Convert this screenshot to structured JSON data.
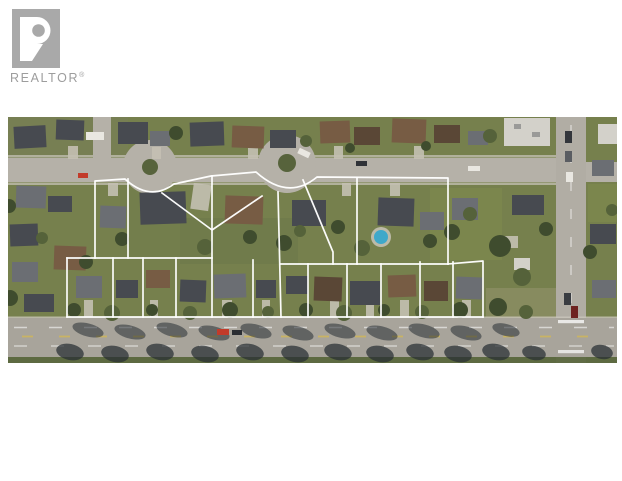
{
  "branding": {
    "logo_text": "REALTOR",
    "registered_symbol": "®"
  },
  "photo": {
    "description": "Aerial drone photo of a suburban neighbourhood: residential street with two cul-de-sac bulbs at top, rows of homes and mature trees, two tiers of property lots outlined in white, a tree-lined arterial road across the bottom and a cross street with an intersection at the right.",
    "palette": {
      "grass": "#76804d",
      "grass-dark": "#5c6840",
      "lawn": "#7f8a4f",
      "road": "#b5b1a8",
      "road-main": "#a8a49b",
      "road-cross": "#b1ada4",
      "sidewalk": "#cac6bc",
      "roof-dark": "#474a50",
      "roof-gray": "#6b6e73",
      "roof-brown": "#775c44",
      "roof-brown-dark": "#5a4736",
      "roof-light": "#d3d1ca",
      "tree": "#3f4c2e",
      "tree-light": "#55623a",
      "shadow": "#272e33",
      "pool": "#3fa8c9",
      "car-red": "#c23b2a",
      "lane-yellow": "#d4b952",
      "drive": "#c4c0b3",
      "island": "#57633c",
      "logo-gray": "#a9a9a9",
      "logo-text": "#9d9d9d"
    },
    "lot_overlay": {
      "stroke_color": "#ffffff",
      "stroke_width": 1.7,
      "upper_lot_count": 6,
      "lower_lot_count": 12,
      "paths": [
        "M95,258 L95,181 L125,179 Q150,202 174,184 L211,176 L256,172 Q288,201 317,177 L448,178 L448,264",
        "M281,264 L448,264",
        "M128,179 L128,258",
        "M162,193 L212,230 L262,196",
        "M212,176 L212,317",
        "M253,260 L253,317",
        "M278,192 L281,317",
        "M303,180 L333,252 L333,264",
        "M357,178 L357,264",
        "M67,258 L212,258",
        "M67,258 L67,317",
        "M67,317 L483,317",
        "M483,317 L483,261 L448,264",
        "M113,258 L113,317",
        "M143,258 L143,317",
        "M176,258 L176,317",
        "M308,264 L308,317",
        "M347,264 L347,317",
        "M381,264 L381,317",
        "M420,262 L420,317",
        "M453,262 L453,317"
      ]
    }
  }
}
